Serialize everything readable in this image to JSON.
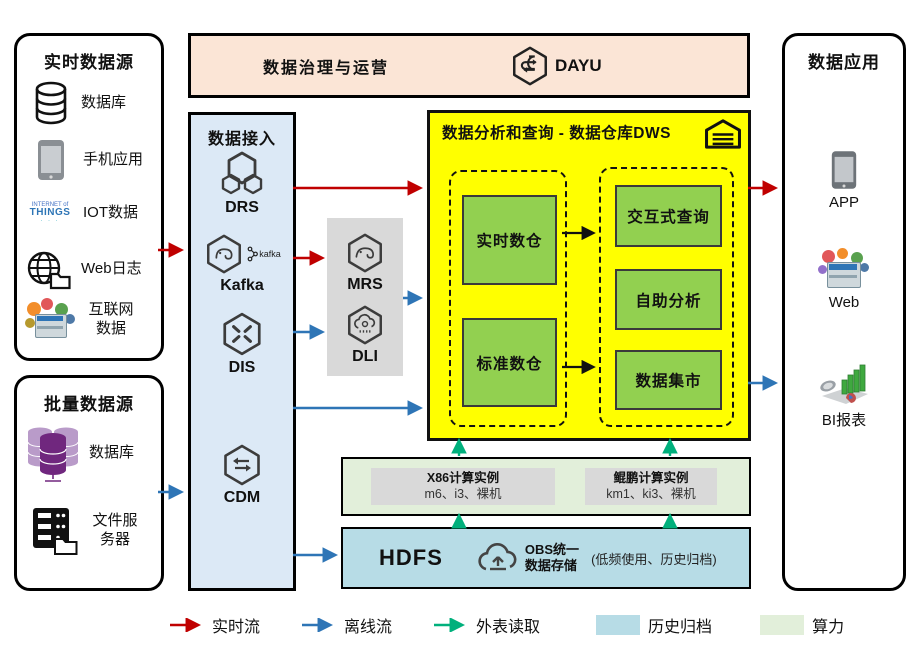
{
  "colors": {
    "realtime_flow": "#C00000",
    "offline_flow": "#2E75B6",
    "external_read": "#00B07C",
    "history_archive": "#B7DCE6",
    "compute_bg": "#E2EFDA",
    "warehouse_bg": "#FFFF00",
    "green_box": "#92D050",
    "ingest_bg": "#DCE9F6",
    "banner_bg": "#FBE5D6",
    "gray_panel": "#D9D9D9"
  },
  "banner": {
    "title": "数据治理与运营",
    "product": "DAYU"
  },
  "realtime_sources": {
    "title": "实时数据源",
    "items": [
      {
        "icon": "database-icon",
        "label": "数据库"
      },
      {
        "icon": "phone-icon",
        "label": "手机应用"
      },
      {
        "icon": "iot-icon",
        "label": "IOT数据",
        "icon_text_1": "INTERNET of",
        "icon_text_2": "THINGS",
        "icon_text_3": "· · ·"
      },
      {
        "icon": "weblog-icon",
        "label": "Web日志"
      },
      {
        "icon": "internet-icon",
        "label": "互联网数据"
      }
    ]
  },
  "batch_sources": {
    "title": "批量数据源",
    "items": [
      {
        "icon": "database-purple-icon",
        "label": "数据库"
      },
      {
        "icon": "file-server-icon",
        "label": "文件服务器"
      }
    ]
  },
  "ingest": {
    "title": "数据接入",
    "services": [
      "DRS",
      "Kafka",
      "DIS",
      "CDM"
    ],
    "kafka_logo": "kafka"
  },
  "processing": {
    "services": [
      "MRS",
      "DLI"
    ]
  },
  "warehouse": {
    "title": "数据分析和查询 - 数据仓库DWS",
    "left_boxes": [
      "实时数仓",
      "标准数仓"
    ],
    "right_boxes": [
      "交互式查询",
      "自助分析",
      "数据集市"
    ]
  },
  "compute": {
    "x86": {
      "line1": "X86计算实例",
      "line2": "m6、i3、裸机"
    },
    "kunpeng": {
      "line1": "鲲鹏计算实例",
      "line2": "km1、ki3、裸机"
    }
  },
  "storage": {
    "hdfs": "HDFS",
    "obs_line1": "OBS统一",
    "obs_line2": "数据存储",
    "note": "(低频使用、历史归档)"
  },
  "applications": {
    "title": "数据应用",
    "items": [
      {
        "icon": "app-icon",
        "label": "APP"
      },
      {
        "icon": "web-icon",
        "label": "Web"
      },
      {
        "icon": "bi-icon",
        "label": "BI报表"
      }
    ]
  },
  "legend": {
    "realtime": "实时流",
    "offline": "离线流",
    "external": "外表读取",
    "archive": "历史归档",
    "compute": "算力"
  }
}
